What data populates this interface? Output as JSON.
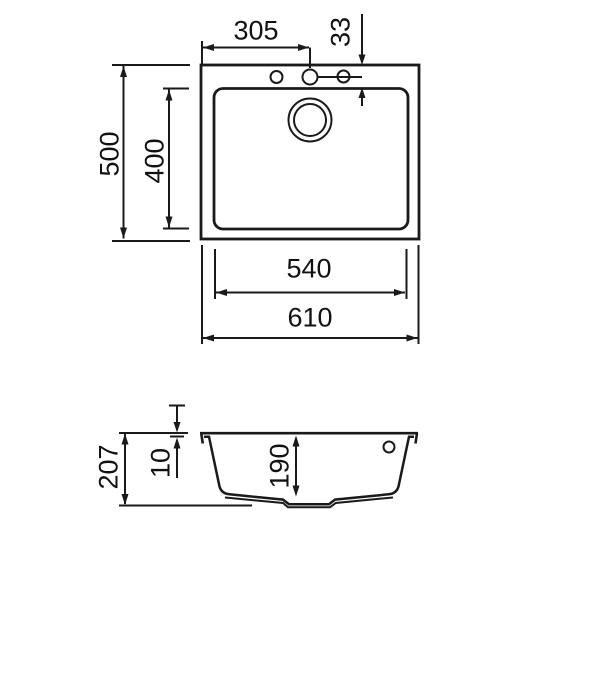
{
  "drawing": {
    "type": "sink-technical-drawing",
    "colors": {
      "line": "#1a1a1a",
      "background": "#ffffff"
    },
    "dimensions": {
      "top_view": {
        "tap_hole_offset_x": "305",
        "tap_hole_offset_y": "33",
        "overall_depth": "500",
        "bowl_inner_depth": "400",
        "bowl_inner_width": "540",
        "overall_width": "610"
      },
      "section_view": {
        "overall_height": "207",
        "rim_thickness": "10",
        "bowl_depth": "190"
      }
    }
  }
}
